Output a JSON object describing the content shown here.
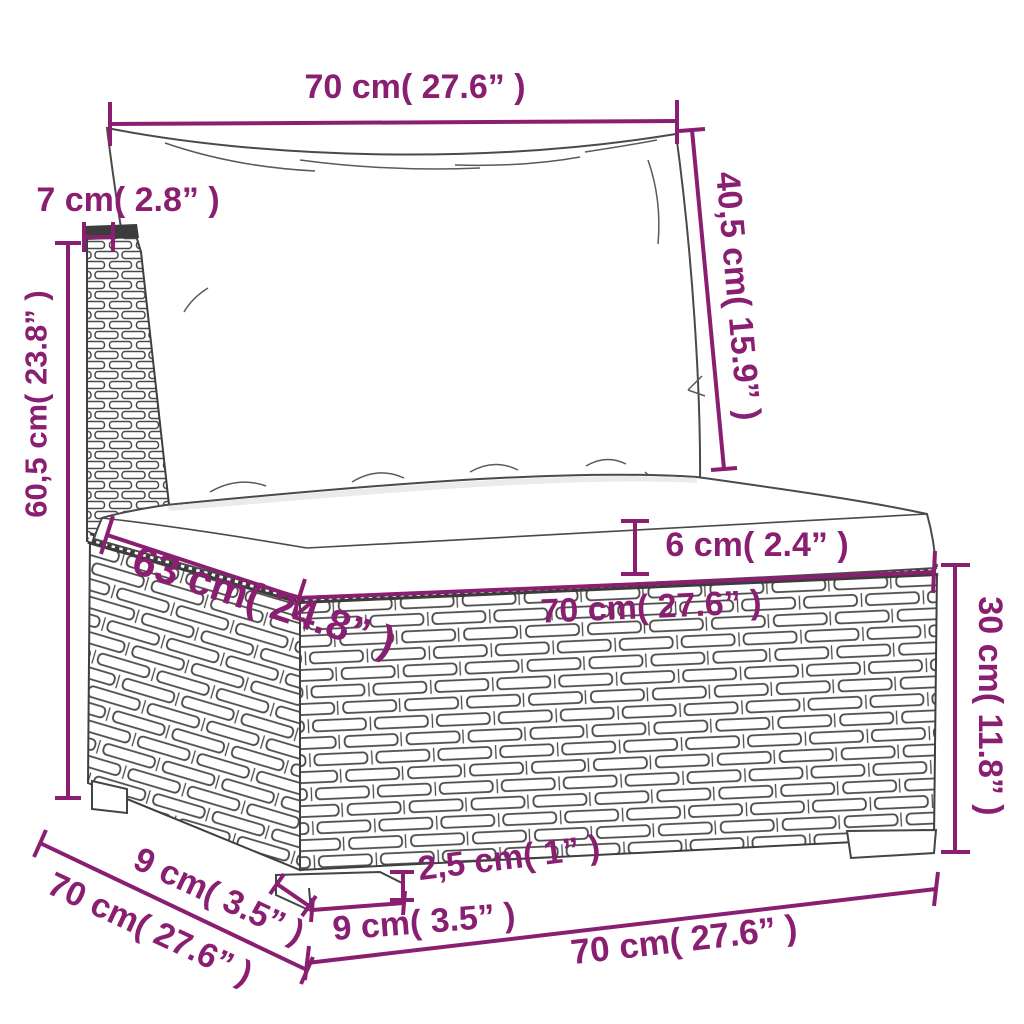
{
  "diagram": {
    "kind": "furniture-dimension-diagram",
    "subject": "rattan-sofa-middle-section",
    "colors": {
      "dimension_accent": "#8A1F72",
      "line_art": "#4A4A4A",
      "background": "#FFFFFF"
    },
    "labels": {
      "cushion_width_top": "70 cm( 27.6” )",
      "backrest_thickness": "7 cm( 2.8” )",
      "back_cushion_height": "40,5 cm( 15.9” )",
      "total_height": "60,5 cm( 23.8” )",
      "seat_cushion_thickness": "6 cm( 2.4” )",
      "seat_depth": "63 cm( 24.8” )",
      "seat_width": "70 cm( 27.6” )",
      "base_height": "30 cm( 11.8” )",
      "leg_depth": "9 cm( 3.5” )",
      "total_depth": "70 cm( 27.6” )",
      "leg_height": "2,5 cm( 1” )",
      "leg_width": "9 cm( 3.5” )",
      "base_width": "70 cm( 27.6” )"
    }
  }
}
